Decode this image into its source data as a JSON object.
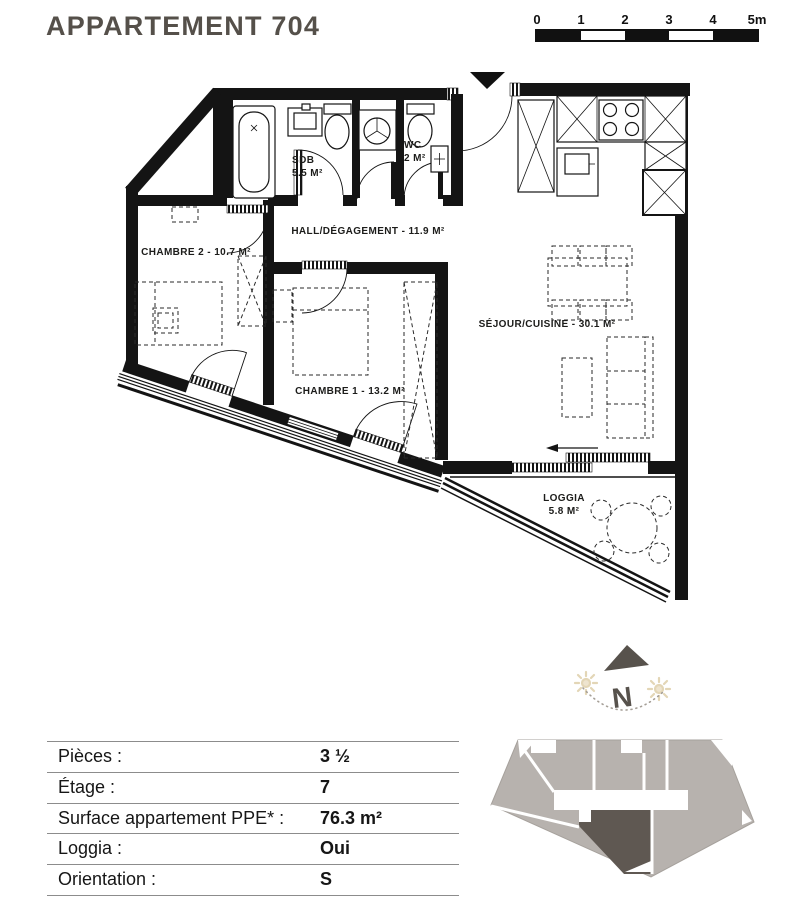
{
  "header": {
    "title": "APPARTEMENT 704"
  },
  "scale_bar": {
    "labels": [
      "0",
      "1",
      "2",
      "3",
      "4",
      "5m"
    ]
  },
  "floor_plan": {
    "rooms": {
      "sdb": {
        "name": "SDB",
        "area": "5.5 M²"
      },
      "wc": {
        "name": "WC",
        "area": "2 M²"
      },
      "hall": {
        "label": "HALL/DÉGAGEMENT - 11.9 M²"
      },
      "chambre2": {
        "label": "CHAMBRE 2 - 10.7 M²"
      },
      "chambre1": {
        "label": "CHAMBRE 1 - 13.2 M²"
      },
      "sejour": {
        "label": "SÉJOUR/CUISINE - 30.1 M²"
      },
      "loggia": {
        "name": "LOGGIA",
        "area": "5.8 M²"
      }
    },
    "compass": {
      "north_label": "N"
    }
  },
  "info_table": {
    "rows": [
      {
        "label": "Pièces :",
        "value": "3 ½"
      },
      {
        "label": "Étage :",
        "value": "7"
      },
      {
        "label": "Surface appartement PPE* :",
        "value": "76.3 m²"
      },
      {
        "label": "Loggia :",
        "value": "Oui"
      },
      {
        "label": "Orientation :",
        "value": "S"
      }
    ]
  },
  "colors": {
    "wall": "#141414",
    "title_text": "#55504a",
    "footprint_light": "#b7b2ae",
    "footprint_highlight": "#5f5852",
    "sun_accent": "#e3d6b6"
  }
}
